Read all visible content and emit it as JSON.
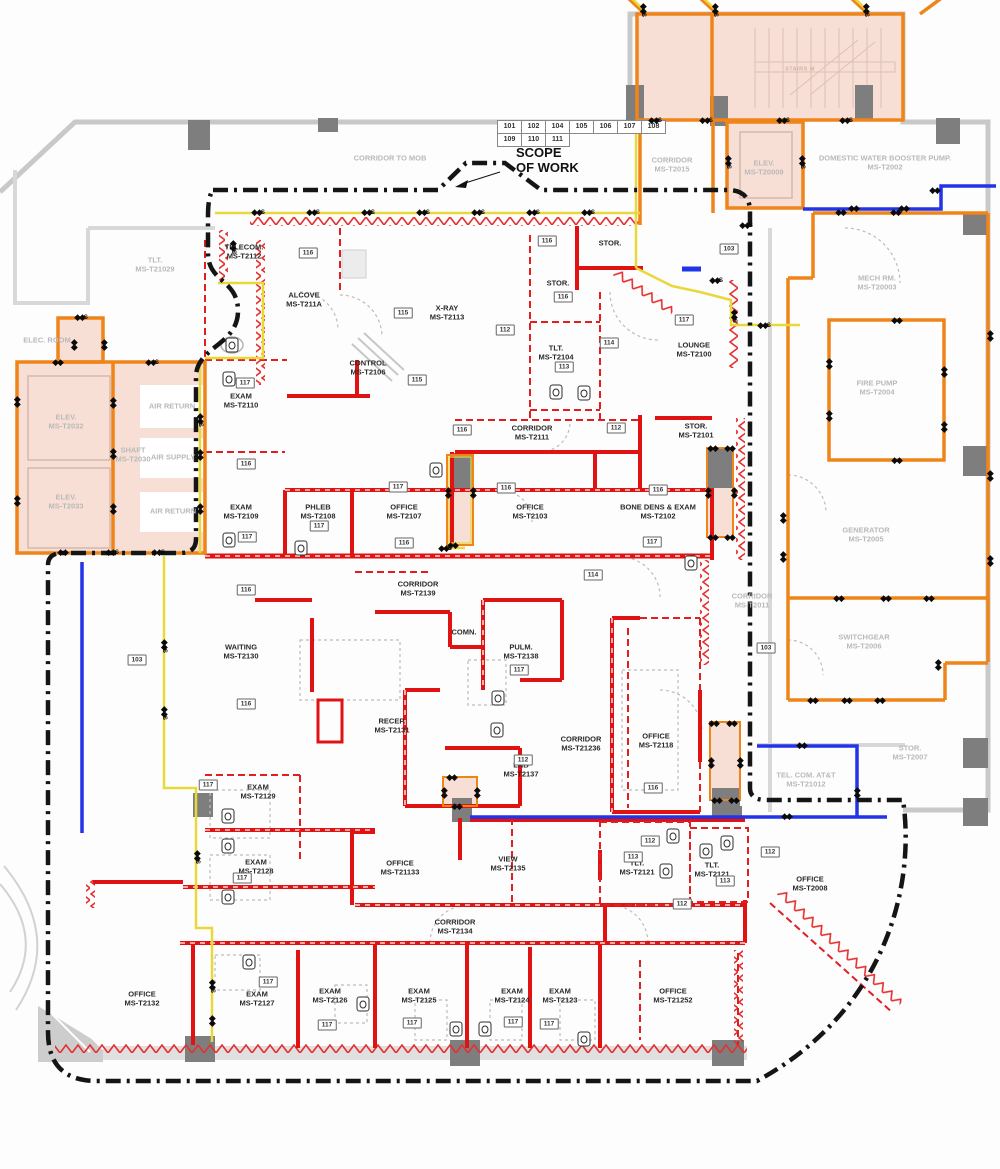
{
  "legend": {
    "scope_line1": "SCOPE",
    "scope_line2": "OF WORK"
  },
  "key_table": {
    "row1": [
      "101",
      "102",
      "104",
      "105",
      "106",
      "107",
      "108"
    ],
    "row2": [
      "109",
      "110",
      "111"
    ]
  },
  "colors": {
    "scope_boundary_black": "#151515",
    "demolition_red": "#e11212",
    "power_orange": "#ef8418",
    "signal_yellow": "#e8d83c",
    "plumbing_blue": "#2233e8",
    "shaded_pink": "#f8dfd6",
    "existing_gray_text": "#b9b9b9"
  },
  "rooms": [
    {
      "name": "CORRIDOR TO MOB",
      "id": "",
      "x": 390,
      "y": 158,
      "c": "g"
    },
    {
      "name": "CORRIDOR",
      "id": "MS-T2015",
      "x": 672,
      "y": 165,
      "c": "g"
    },
    {
      "name": "ELEV.",
      "id": "MS-T20009",
      "x": 764,
      "y": 168,
      "c": "g"
    },
    {
      "name": "DOMESTIC WATER BOOSTER PUMP.",
      "id": "MS-T2002",
      "x": 885,
      "y": 163,
      "c": "g"
    },
    {
      "name": "STAIRS M",
      "id": "",
      "x": 800,
      "y": 70,
      "c": "g s"
    },
    {
      "name": "TLT.",
      "id": "MS-T21029",
      "x": 155,
      "y": 265,
      "c": "g"
    },
    {
      "name": "ELEC. ROOM",
      "id": "",
      "x": 47,
      "y": 340,
      "c": "g"
    },
    {
      "name": "MECH RM.",
      "id": "MS-T20003",
      "x": 877,
      "y": 283,
      "c": "g"
    },
    {
      "name": "FIRE PUMP",
      "id": "MS-T2004",
      "x": 877,
      "y": 388,
      "c": "g"
    },
    {
      "name": "ELEV.",
      "id": "MS-T2032",
      "x": 66,
      "y": 422,
      "c": "g"
    },
    {
      "name": "AIR RETURN",
      "id": "",
      "x": 172,
      "y": 406,
      "c": "g"
    },
    {
      "name": "SHAFT",
      "id": "MS-T2030",
      "x": 133,
      "y": 455,
      "c": "g"
    },
    {
      "name": "AIR SUPPLY",
      "id": "",
      "x": 173,
      "y": 457,
      "c": "g"
    },
    {
      "name": "ELEV.",
      "id": "MS-T2033",
      "x": 66,
      "y": 502,
      "c": "g"
    },
    {
      "name": "AIR RETURN",
      "id": "",
      "x": 173,
      "y": 511,
      "c": "g"
    },
    {
      "name": "GENERATOR",
      "id": "MS-T2005",
      "x": 866,
      "y": 535,
      "c": "g"
    },
    {
      "name": "CORRIDOR",
      "id": "MS-T2011",
      "x": 752,
      "y": 601,
      "c": "g"
    },
    {
      "name": "SWITCHGEAR",
      "id": "MS-T2006",
      "x": 864,
      "y": 642,
      "c": "g"
    },
    {
      "name": "STOR.",
      "id": "MS-T2007",
      "x": 910,
      "y": 753,
      "c": "g"
    },
    {
      "name": "TEL. COM. AT&T",
      "id": "MS-T21012",
      "x": 806,
      "y": 780,
      "c": "g"
    },
    {
      "name": "TELECOM.",
      "id": "MS-T2112",
      "x": 244,
      "y": 252,
      "c": ""
    },
    {
      "name": "ALCOVE",
      "id": "MS-T211A",
      "x": 304,
      "y": 300,
      "c": ""
    },
    {
      "name": "X-RAY",
      "id": "MS-T2113",
      "x": 447,
      "y": 313,
      "c": ""
    },
    {
      "name": "CONTROL",
      "id": "MS-T2106",
      "x": 368,
      "y": 368,
      "c": ""
    },
    {
      "name": "STOR.",
      "id": "",
      "x": 610,
      "y": 243,
      "c": ""
    },
    {
      "name": "STOR.",
      "id": "",
      "x": 558,
      "y": 283,
      "c": ""
    },
    {
      "name": "TLT.",
      "id": "MS-T2104",
      "x": 556,
      "y": 353,
      "c": ""
    },
    {
      "name": "LOUNGE",
      "id": "MS-T2100",
      "x": 694,
      "y": 350,
      "c": ""
    },
    {
      "name": "EXAM",
      "id": "MS-T2110",
      "x": 241,
      "y": 401,
      "c": ""
    },
    {
      "name": "CORRIDOR",
      "id": "MS-T2111",
      "x": 532,
      "y": 433,
      "c": ""
    },
    {
      "name": "STOR.",
      "id": "MS-T2101",
      "x": 696,
      "y": 431,
      "c": ""
    },
    {
      "name": "EXAM",
      "id": "MS-T2109",
      "x": 241,
      "y": 512,
      "c": ""
    },
    {
      "name": "PHLEB",
      "id": "MS-T2108",
      "x": 318,
      "y": 512,
      "c": ""
    },
    {
      "name": "OFFICE",
      "id": "MS-T2107",
      "x": 404,
      "y": 512,
      "c": ""
    },
    {
      "name": "OFFICE",
      "id": "MS-T2103",
      "x": 530,
      "y": 512,
      "c": ""
    },
    {
      "name": "BONE DENS & EXAM",
      "id": "MS-T2102",
      "x": 658,
      "y": 512,
      "c": ""
    },
    {
      "name": "CORRIDOR",
      "id": "MS-T2139",
      "x": 418,
      "y": 589,
      "c": ""
    },
    {
      "name": "COMN.",
      "id": "",
      "x": 464,
      "y": 632,
      "c": ""
    },
    {
      "name": "PULM.",
      "id": "MS-T2138",
      "x": 521,
      "y": 652,
      "c": ""
    },
    {
      "name": "WAITING",
      "id": "MS-T2130",
      "x": 241,
      "y": 652,
      "c": ""
    },
    {
      "name": "RECEP.",
      "id": "MS-T2131",
      "x": 392,
      "y": 726,
      "c": ""
    },
    {
      "name": "CORRIDOR",
      "id": "MS-T21236",
      "x": 581,
      "y": 744,
      "c": ""
    },
    {
      "name": "OFFICE",
      "id": "MS-T2118",
      "x": 656,
      "y": 741,
      "c": ""
    },
    {
      "name": "LAB",
      "id": "MS-T2137",
      "x": 521,
      "y": 770,
      "c": ""
    },
    {
      "name": "EXAM",
      "id": "MS-T2129",
      "x": 258,
      "y": 792,
      "c": ""
    },
    {
      "name": "EXAM",
      "id": "MS-T2128",
      "x": 256,
      "y": 867,
      "c": ""
    },
    {
      "name": "OFFICE",
      "id": "MS-T21133",
      "x": 400,
      "y": 868,
      "c": ""
    },
    {
      "name": "VIEW",
      "id": "MS-T2135",
      "x": 508,
      "y": 864,
      "c": ""
    },
    {
      "name": "TLT.",
      "id": "MS-T2121",
      "x": 637,
      "y": 868,
      "c": ""
    },
    {
      "name": "TLT.",
      "id": "MS-T2121",
      "x": 712,
      "y": 870,
      "c": ""
    },
    {
      "name": "OFFICE",
      "id": "MS-T2008",
      "x": 810,
      "y": 884,
      "c": ""
    },
    {
      "name": "CORRIDOR",
      "id": "MS-T2134",
      "x": 455,
      "y": 927,
      "c": ""
    },
    {
      "name": "OFFICE",
      "id": "MS-T2132",
      "x": 142,
      "y": 999,
      "c": ""
    },
    {
      "name": "EXAM",
      "id": "MS-T2127",
      "x": 257,
      "y": 999,
      "c": ""
    },
    {
      "name": "EXAM",
      "id": "MS-T2126",
      "x": 330,
      "y": 996,
      "c": ""
    },
    {
      "name": "EXAM",
      "id": "MS-T2125",
      "x": 419,
      "y": 996,
      "c": ""
    },
    {
      "name": "EXAM",
      "id": "MS-T2124",
      "x": 512,
      "y": 996,
      "c": ""
    },
    {
      "name": "EXAM",
      "id": "MS-T2123",
      "x": 560,
      "y": 996,
      "c": ""
    },
    {
      "name": "OFFICE",
      "id": "MS-T21252",
      "x": 673,
      "y": 996,
      "c": ""
    }
  ],
  "callouts": [
    {
      "n": "116",
      "x": 308,
      "y": 253
    },
    {
      "n": "116",
      "x": 547,
      "y": 241
    },
    {
      "n": "103",
      "x": 729,
      "y": 249
    },
    {
      "n": "116",
      "x": 563,
      "y": 297
    },
    {
      "n": "115",
      "x": 403,
      "y": 313
    },
    {
      "n": "112",
      "x": 505,
      "y": 330
    },
    {
      "n": "117",
      "x": 684,
      "y": 320
    },
    {
      "n": "114",
      "x": 609,
      "y": 343
    },
    {
      "n": "113",
      "x": 564,
      "y": 367
    },
    {
      "n": "115",
      "x": 417,
      "y": 380
    },
    {
      "n": "117",
      "x": 245,
      "y": 383
    },
    {
      "n": "116",
      "x": 462,
      "y": 430
    },
    {
      "n": "112",
      "x": 616,
      "y": 428
    },
    {
      "n": "116",
      "x": 246,
      "y": 464
    },
    {
      "n": "117",
      "x": 398,
      "y": 487
    },
    {
      "n": "116",
      "x": 506,
      "y": 488
    },
    {
      "n": "116",
      "x": 658,
      "y": 490
    },
    {
      "n": "117",
      "x": 319,
      "y": 526
    },
    {
      "n": "117",
      "x": 247,
      "y": 537
    },
    {
      "n": "116",
      "x": 404,
      "y": 543
    },
    {
      "n": "117",
      "x": 652,
      "y": 542
    },
    {
      "n": "114",
      "x": 593,
      "y": 575
    },
    {
      "n": "116",
      "x": 246,
      "y": 590
    },
    {
      "n": "103",
      "x": 137,
      "y": 660
    },
    {
      "n": "117",
      "x": 519,
      "y": 670
    },
    {
      "n": "116",
      "x": 246,
      "y": 704
    },
    {
      "n": "112",
      "x": 523,
      "y": 760
    },
    {
      "n": "116",
      "x": 653,
      "y": 788
    },
    {
      "n": "103",
      "x": 766,
      "y": 648
    },
    {
      "n": "117",
      "x": 208,
      "y": 785
    },
    {
      "n": "117",
      "x": 242,
      "y": 878
    },
    {
      "n": "112",
      "x": 650,
      "y": 841
    },
    {
      "n": "113",
      "x": 633,
      "y": 857
    },
    {
      "n": "112",
      "x": 770,
      "y": 852
    },
    {
      "n": "113",
      "x": 725,
      "y": 881
    },
    {
      "n": "112",
      "x": 682,
      "y": 904
    },
    {
      "n": "117",
      "x": 268,
      "y": 982
    },
    {
      "n": "117",
      "x": 327,
      "y": 1025
    },
    {
      "n": "117",
      "x": 412,
      "y": 1023
    },
    {
      "n": "117",
      "x": 513,
      "y": 1022
    },
    {
      "n": "117",
      "x": 549,
      "y": 1024
    }
  ],
  "markers": [
    {
      "x": 258,
      "y": 213,
      "a": 0,
      "s": "S"
    },
    {
      "x": 313,
      "y": 213,
      "a": 0,
      "s": "S"
    },
    {
      "x": 368,
      "y": 213,
      "a": 0,
      "s": "S"
    },
    {
      "x": 423,
      "y": 213,
      "a": 0,
      "s": "S"
    },
    {
      "x": 478,
      "y": 213,
      "a": 0,
      "s": "S"
    },
    {
      "x": 533,
      "y": 213,
      "a": 0,
      "s": "S"
    },
    {
      "x": 588,
      "y": 213,
      "a": 0,
      "s": "S"
    },
    {
      "x": 643,
      "y": 10,
      "a": 90,
      "s": "S"
    },
    {
      "x": 715,
      "y": 10,
      "a": 90,
      "s": "S"
    },
    {
      "x": 866,
      "y": 10,
      "a": 90,
      "s": "S"
    },
    {
      "x": 655,
      "y": 121,
      "a": 0,
      "s": "S"
    },
    {
      "x": 706,
      "y": 121,
      "a": 0,
      "s": "S"
    },
    {
      "x": 783,
      "y": 121,
      "a": 0,
      "s": "S"
    },
    {
      "x": 846,
      "y": 121,
      "a": 0,
      "s": "S"
    },
    {
      "x": 728,
      "y": 162,
      "a": 90,
      "s": "S"
    },
    {
      "x": 802,
      "y": 162,
      "a": 90,
      "s": "S"
    },
    {
      "x": 746,
      "y": 226,
      "a": 0,
      "s": "S"
    },
    {
      "x": 840,
      "y": 213,
      "a": 0,
      "s": ""
    },
    {
      "x": 895,
      "y": 213,
      "a": 0,
      "s": ""
    },
    {
      "x": 853,
      "y": 209,
      "a": 0,
      "s": ""
    },
    {
      "x": 903,
      "y": 209,
      "a": 0,
      "s": ""
    },
    {
      "x": 934,
      "y": 191,
      "a": 0,
      "s": ""
    },
    {
      "x": 990,
      "y": 335,
      "a": 90,
      "s": ""
    },
    {
      "x": 990,
      "y": 475,
      "a": 90,
      "s": ""
    },
    {
      "x": 990,
      "y": 560,
      "a": 90,
      "s": ""
    },
    {
      "x": 896,
      "y": 321,
      "a": 0,
      "s": ""
    },
    {
      "x": 829,
      "y": 363,
      "a": 90,
      "s": ""
    },
    {
      "x": 829,
      "y": 415,
      "a": 90,
      "s": ""
    },
    {
      "x": 944,
      "y": 371,
      "a": 90,
      "s": ""
    },
    {
      "x": 944,
      "y": 426,
      "a": 90,
      "s": ""
    },
    {
      "x": 896,
      "y": 461,
      "a": 0,
      "s": ""
    },
    {
      "x": 783,
      "y": 517,
      "a": 90,
      "s": ""
    },
    {
      "x": 783,
      "y": 556,
      "a": 90,
      "s": ""
    },
    {
      "x": 838,
      "y": 599,
      "a": 0,
      "s": ""
    },
    {
      "x": 885,
      "y": 599,
      "a": 0,
      "s": ""
    },
    {
      "x": 928,
      "y": 599,
      "a": 0,
      "s": ""
    },
    {
      "x": 812,
      "y": 701,
      "a": 0,
      "s": ""
    },
    {
      "x": 846,
      "y": 701,
      "a": 0,
      "s": ""
    },
    {
      "x": 879,
      "y": 701,
      "a": 0,
      "s": ""
    },
    {
      "x": 938,
      "y": 664,
      "a": 90,
      "s": ""
    },
    {
      "x": 801,
      "y": 746,
      "a": 0,
      "s": ""
    },
    {
      "x": 857,
      "y": 792,
      "a": 90,
      "s": ""
    },
    {
      "x": 786,
      "y": 817,
      "a": 0,
      "s": ""
    },
    {
      "x": 164,
      "y": 646,
      "a": 90,
      "s": "S"
    },
    {
      "x": 164,
      "y": 713,
      "a": 90,
      "s": "S"
    },
    {
      "x": 197,
      "y": 857,
      "a": 90,
      "s": "S"
    },
    {
      "x": 212,
      "y": 986,
      "a": 90,
      "s": "S"
    },
    {
      "x": 212,
      "y": 1020,
      "a": 90,
      "s": ""
    },
    {
      "x": 152,
      "y": 363,
      "a": 0,
      "s": "S"
    },
    {
      "x": 57,
      "y": 363,
      "a": 0,
      "s": ""
    },
    {
      "x": 17,
      "y": 401,
      "a": 90,
      "s": ""
    },
    {
      "x": 17,
      "y": 500,
      "a": 90,
      "s": ""
    },
    {
      "x": 113,
      "y": 402,
      "a": 90,
      "s": ""
    },
    {
      "x": 113,
      "y": 453,
      "a": 90,
      "s": ""
    },
    {
      "x": 113,
      "y": 508,
      "a": 90,
      "s": ""
    },
    {
      "x": 200,
      "y": 420,
      "a": 90,
      "s": "S"
    },
    {
      "x": 200,
      "y": 454,
      "a": 90,
      "s": ""
    },
    {
      "x": 200,
      "y": 508,
      "a": 90,
      "s": ""
    },
    {
      "x": 62,
      "y": 553,
      "a": 0,
      "s": ""
    },
    {
      "x": 112,
      "y": 553,
      "a": 0,
      "s": "S"
    },
    {
      "x": 158,
      "y": 553,
      "a": 0,
      "s": "S"
    },
    {
      "x": 445,
      "y": 549,
      "a": 0,
      "s": "S"
    },
    {
      "x": 81,
      "y": 318,
      "a": 0,
      "s": "S"
    },
    {
      "x": 74,
      "y": 344,
      "a": 90,
      "s": ""
    },
    {
      "x": 104,
      "y": 344,
      "a": 90,
      "s": ""
    },
    {
      "x": 233,
      "y": 247,
      "a": 90,
      "s": "S"
    },
    {
      "x": 716,
      "y": 281,
      "a": 0,
      "s": "S"
    },
    {
      "x": 734,
      "y": 316,
      "a": 90,
      "s": "S"
    },
    {
      "x": 764,
      "y": 326,
      "a": 0,
      "s": "S"
    },
    {
      "x": 452,
      "y": 546,
      "a": 0,
      "s": ""
    },
    {
      "x": 448,
      "y": 492,
      "a": 90,
      "s": ""
    },
    {
      "x": 473,
      "y": 492,
      "a": 90,
      "s": ""
    },
    {
      "x": 712,
      "y": 449,
      "a": 0,
      "s": ""
    },
    {
      "x": 729,
      "y": 449,
      "a": 0,
      "s": ""
    },
    {
      "x": 708,
      "y": 492,
      "a": 90,
      "s": ""
    },
    {
      "x": 734,
      "y": 492,
      "a": 90,
      "s": ""
    },
    {
      "x": 712,
      "y": 538,
      "a": 0,
      "s": ""
    },
    {
      "x": 729,
      "y": 538,
      "a": 0,
      "s": ""
    },
    {
      "x": 713,
      "y": 724,
      "a": 0,
      "s": ""
    },
    {
      "x": 731,
      "y": 724,
      "a": 0,
      "s": ""
    },
    {
      "x": 711,
      "y": 762,
      "a": 90,
      "s": ""
    },
    {
      "x": 740,
      "y": 762,
      "a": 90,
      "s": ""
    },
    {
      "x": 716,
      "y": 801,
      "a": 0,
      "s": ""
    },
    {
      "x": 733,
      "y": 801,
      "a": 0,
      "s": ""
    },
    {
      "x": 451,
      "y": 778,
      "a": 0,
      "s": ""
    },
    {
      "x": 444,
      "y": 792,
      "a": 90,
      "s": ""
    },
    {
      "x": 477,
      "y": 792,
      "a": 90,
      "s": ""
    },
    {
      "x": 456,
      "y": 807,
      "a": 0,
      "s": ""
    }
  ],
  "fixtures": [
    {
      "x": 232,
      "y": 345
    },
    {
      "x": 556,
      "y": 392
    },
    {
      "x": 584,
      "y": 393
    },
    {
      "x": 229,
      "y": 379
    },
    {
      "x": 229,
      "y": 540
    },
    {
      "x": 301,
      "y": 548
    },
    {
      "x": 436,
      "y": 470
    },
    {
      "x": 691,
      "y": 563
    },
    {
      "x": 498,
      "y": 698
    },
    {
      "x": 497,
      "y": 730
    },
    {
      "x": 228,
      "y": 816
    },
    {
      "x": 228,
      "y": 846
    },
    {
      "x": 228,
      "y": 897
    },
    {
      "x": 249,
      "y": 962
    },
    {
      "x": 363,
      "y": 1004
    },
    {
      "x": 456,
      "y": 1029
    },
    {
      "x": 485,
      "y": 1029
    },
    {
      "x": 584,
      "y": 1039
    },
    {
      "x": 673,
      "y": 836
    },
    {
      "x": 706,
      "y": 851
    },
    {
      "x": 666,
      "y": 871
    },
    {
      "x": 727,
      "y": 843
    }
  ]
}
